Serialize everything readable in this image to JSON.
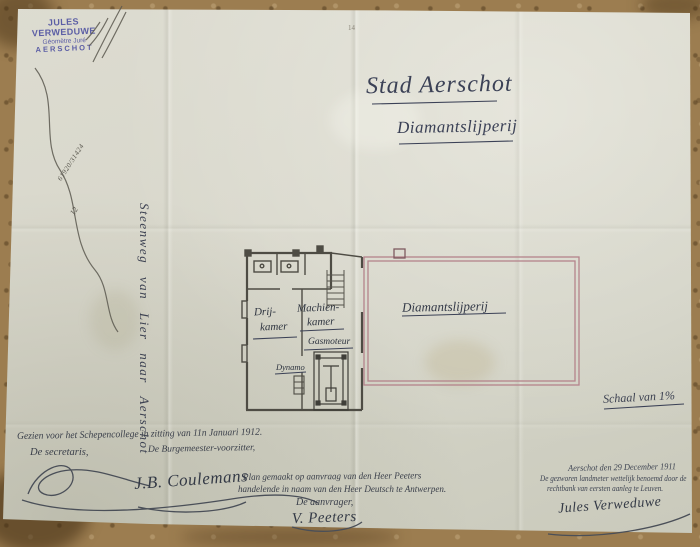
{
  "stamp": {
    "name": "JULES VERWEDUWE",
    "title": "Géomètre Juré",
    "city": "AERSCHOT"
  },
  "registry_marks": {
    "numbers": "61920/31424",
    "folio": "12",
    "page_mark": "14"
  },
  "title": {
    "line1": "Stad Aerschot",
    "line2": "Diamantslijperij"
  },
  "road_label": "Steenweg van Lier naar Aerschot",
  "plan": {
    "room1_line1": "Drij-",
    "room1_line2": "kamer",
    "room2_line1": "Machien-",
    "room2_line2": "kamer",
    "gasmotor_label": "Gasmoteur",
    "dynamo_label": "Dynamo",
    "main_hall_label": "Diamantslijperij",
    "wall_color": "#4e4c44",
    "hall_wall_color": "#b4838b"
  },
  "scale_note": "Schaal van 1%",
  "approval": {
    "seen_line": "Gezien voor het Schepencollege in zitting van 11n Januari 1912.",
    "secretary_label": "De secretaris,",
    "mayor_label": "De Burgemeester-voorzitter,",
    "mayor_signature": "J.B. Coulemans"
  },
  "request": {
    "line1": "Plan gemaakt op aanvraag van den Heer Peeters",
    "line2": "handelende in naam van den Heer Deutsch te Antwerpen.",
    "closing": "De aanvrager,",
    "signature": "V. Peeters"
  },
  "surveyor": {
    "date_line": "Aerschot den 29 December 1911",
    "line2": "De gezworen landmeter wettelijk benoemd door de",
    "line3": "rechtbank van eersten aanleg te Leuven.",
    "signature": "Jules Verweduwe"
  }
}
